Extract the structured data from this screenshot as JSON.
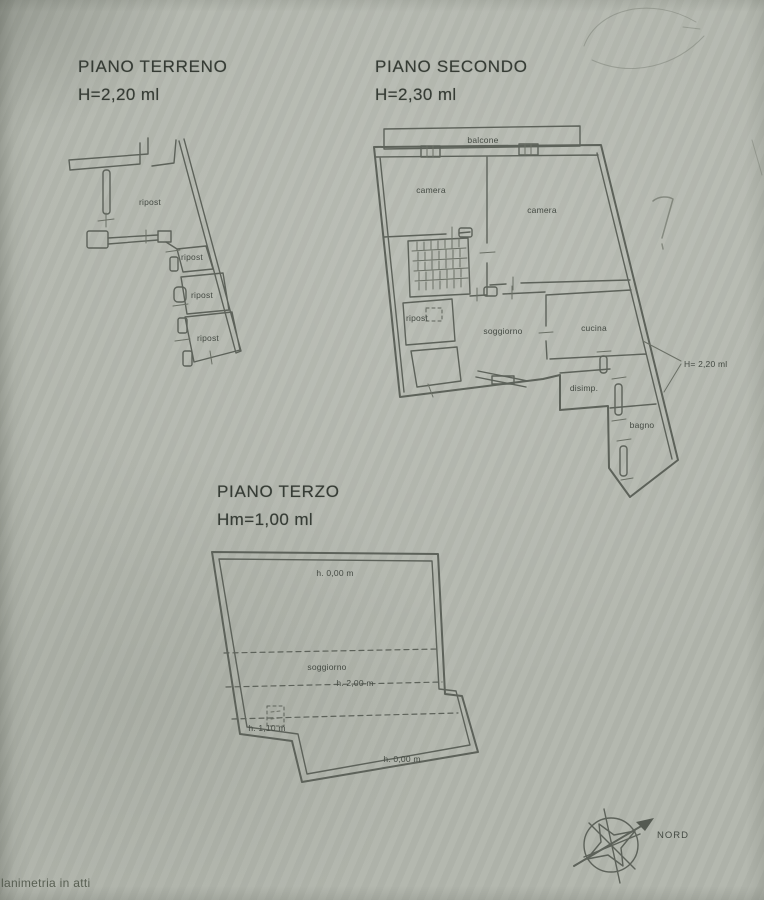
{
  "colors": {
    "paper": "#b2b6ad",
    "ink": "#5d625a",
    "text": "#454b44"
  },
  "titles": {
    "terreno": {
      "name": "PIANO TERRENO",
      "height": "H=2,20 ml"
    },
    "secondo": {
      "name": "PIANO SECONDO",
      "height": "H=2,30 ml"
    },
    "terzo": {
      "name": "PIANO TERZO",
      "height": "Hm=1,00 ml"
    }
  },
  "piano_terreno": {
    "rooms": [
      "ripost",
      "ripost",
      "ripost",
      "ripost"
    ]
  },
  "piano_secondo": {
    "balcone": "balcone",
    "camera_left": "camera",
    "camera_right": "camera",
    "ripost": "ripost",
    "soggiorno": "soggiorno",
    "cucina": "cucina",
    "disimp": "disimp.",
    "bagno": "bagno",
    "annotation": "H= 2,20 ml"
  },
  "piano_terzo": {
    "h_top": "h. 0,00 m",
    "room": "soggiorno",
    "h_mid": "h. 2,00 m",
    "h_low": "h. 1,10 m",
    "h_bottom": "h. 0,00 m"
  },
  "compass": {
    "north": "NORD"
  },
  "footer": {
    "watermark": "lanimetria in atti"
  }
}
